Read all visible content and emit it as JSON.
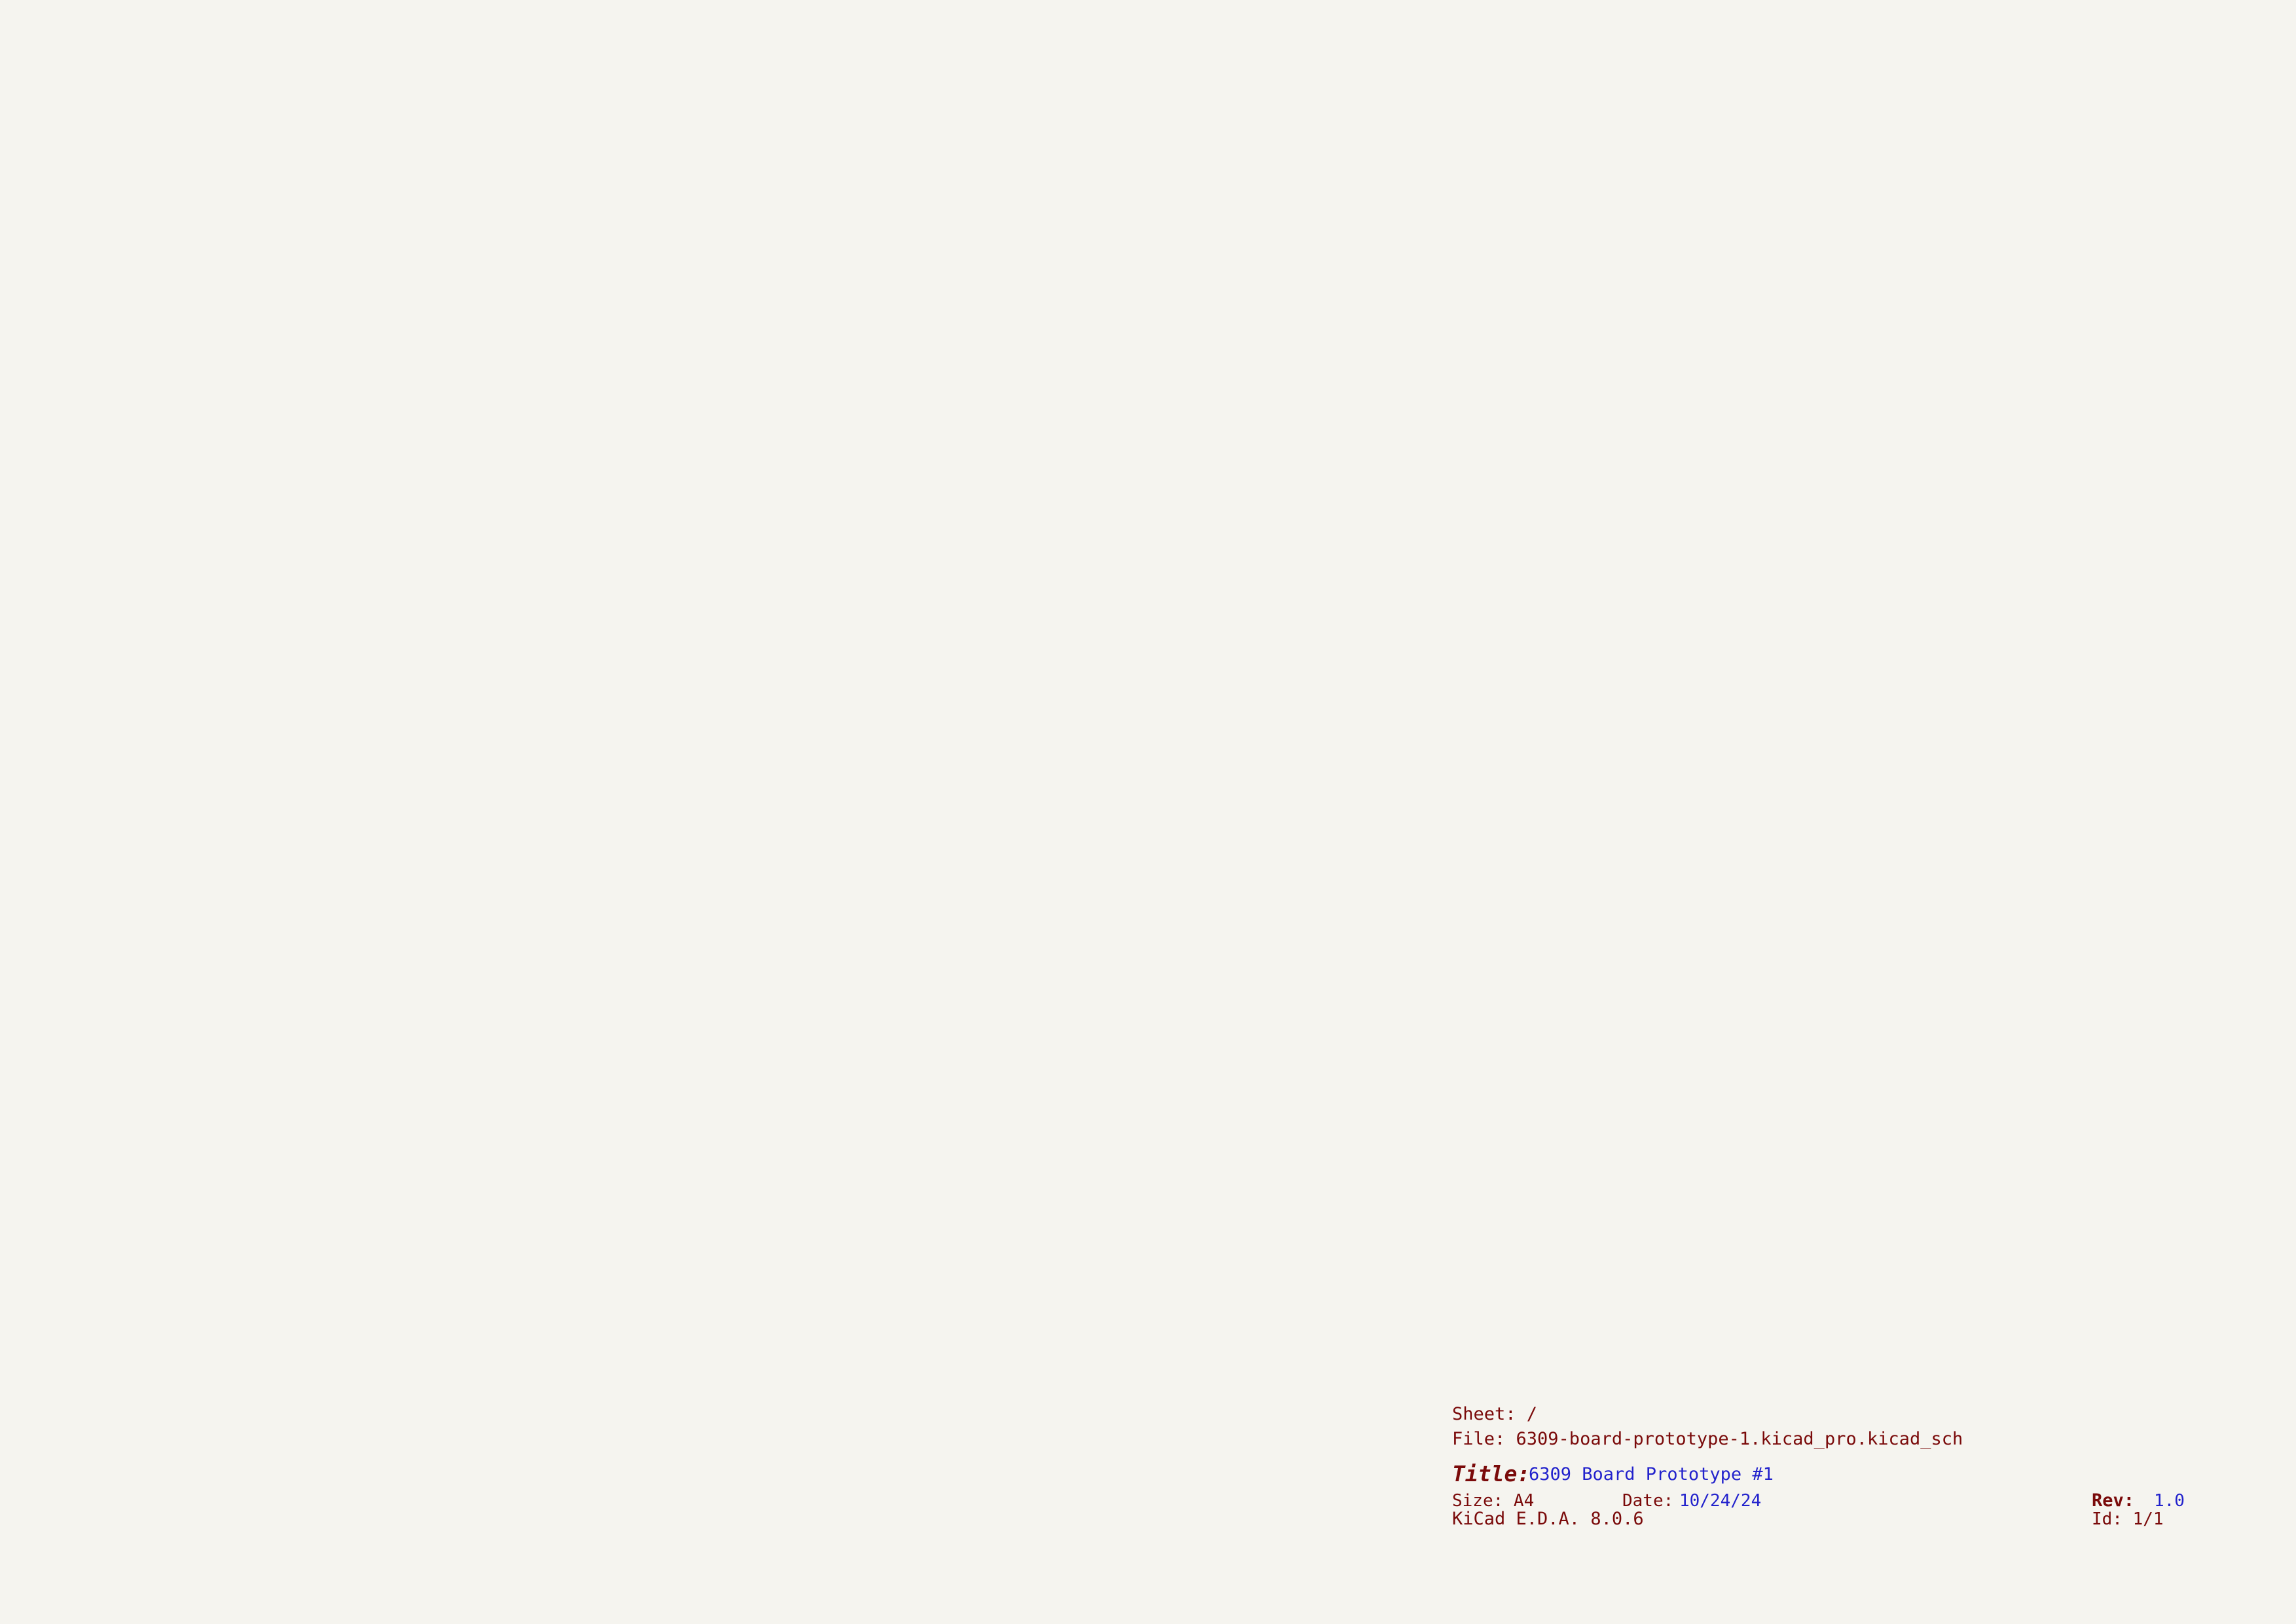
{
  "colors": {
    "background": "#F5F4EF",
    "wire": "#1DA41D",
    "bus": "#1616AE",
    "outline": "#7E0B0B",
    "body_fill": "#FDFAC4",
    "pin_number": "#9E1010",
    "pin_name": "#0E7C7C",
    "label": "#1F1F1F",
    "blue_text": "#2222CC",
    "frame": "#7A0A0A",
    "noconnect": "#2B2BC4"
  },
  "frame": {
    "columns": [
      "1",
      "2",
      "3",
      "4",
      "5",
      "6"
    ],
    "rows": [
      "A",
      "B",
      "C",
      "D"
    ]
  },
  "title_block": {
    "sheet": "Sheet: /",
    "file": "File: 6309-board-prototype-1.kicad_pro.kicad_sch",
    "title_label": "Title:",
    "title": "6309 Board Prototype #1",
    "size": "Size: A4",
    "date_label": "Date:",
    "date": "10/24/24",
    "rev_label": "Rev:",
    "rev": "1.0",
    "tool": "KiCad E.D.A. 8.0.6",
    "id": "Id: 1/1"
  },
  "sections": {
    "cpu": "CPU",
    "ram": "RAM",
    "rom": "ROM",
    "uart": "UART",
    "glue": "GLUE LOGIC",
    "power": "POWER + RESET SWITCH"
  },
  "power": {
    "vcc": "+5V"
  },
  "net_labels": {
    "rw": "R/!W",
    "reset": "!RESET",
    "a15": "A15",
    "na15": "!A15",
    "a8": "A8"
  },
  "ics": {
    "cpu": {
      "ref": "U1",
      "value": "HD63C09",
      "vcc_pin": "7",
      "vcc_name": "VCC",
      "gnd_pin": "1",
      "gnd_name": "VSS",
      "left": [
        {
          "label": "D0",
          "num": "31",
          "name": "D0"
        },
        {
          "label": "D1",
          "num": "30",
          "name": "D1"
        },
        {
          "label": "D2",
          "num": "29",
          "name": "D2"
        },
        {
          "label": "D3",
          "num": "28",
          "name": "D3"
        },
        {
          "label": "D4",
          "num": "27",
          "name": "D4"
        },
        {
          "label": "D5",
          "num": "26",
          "name": "D5"
        },
        {
          "label": "D6",
          "num": "25",
          "name": "D6"
        },
        {
          "label": "D7",
          "num": "24",
          "name": "D7"
        },
        {
          "label": "!RESET",
          "num": "37",
          "name": "RESET",
          "ov": true
        },
        {
          "num": "2",
          "name": "NMI",
          "ov": true
        },
        {
          "num": "3",
          "name": "IRQ",
          "ov": true
        },
        {
          "num": "4",
          "name": "FIRQ",
          "ov": true
        },
        {
          "num": "33",
          "name": "DMA/BREQ",
          "ov": true
        },
        {
          "num": "40",
          "name": "HALT",
          "ov": true
        },
        {
          "num": "36",
          "name": "MRDY"
        },
        {
          "num": "39",
          "name": "XTAL"
        },
        {
          "num": "38",
          "name": "EXTAL"
        }
      ],
      "right": [
        {
          "num": "8",
          "name": "A0",
          "label": "A0"
        },
        {
          "num": "9",
          "name": "A1",
          "label": "A1"
        },
        {
          "num": "10",
          "name": "A2",
          "label": "A2"
        },
        {
          "num": "11",
          "name": "A3",
          "label": "A3"
        },
        {
          "num": "12",
          "name": "A4",
          "label": "A4"
        },
        {
          "num": "13",
          "name": "A5",
          "label": "A5"
        },
        {
          "num": "14",
          "name": "A6",
          "label": "A6"
        },
        {
          "num": "15",
          "name": "A7",
          "label": "A7"
        },
        {
          "num": "16",
          "name": "A8",
          "label": "A8"
        },
        {
          "num": "17",
          "name": "A9",
          "label": "A9"
        },
        {
          "num": "18",
          "name": "A10",
          "label": "A10"
        },
        {
          "num": "19",
          "name": "A11",
          "label": "A11"
        },
        {
          "num": "20",
          "name": "A12",
          "label": "A12"
        },
        {
          "num": "21",
          "name": "A13",
          "label": "A13"
        },
        {
          "num": "22",
          "name": "A14",
          "label": "A14"
        },
        {
          "num": "23",
          "name": "A15",
          "label": "A15"
        },
        {
          "num": "32",
          "name": "R/W",
          "ov": "last",
          "label": "R/!W"
        },
        {
          "num": "5",
          "name": "BS",
          "nc": true
        },
        {
          "num": "6",
          "name": "BA",
          "nc": true
        },
        {
          "num": "34",
          "name": "E"
        },
        {
          "num": "35",
          "name": "Q",
          "nc": true
        }
      ]
    },
    "ram": {
      "ref": "U2",
      "value": "62256",
      "vcc_pin": "28",
      "vcc_name": "VCC",
      "gnd_pin": "14",
      "gnd_name": "GND",
      "left": [
        {
          "label": "A0",
          "num": "10",
          "name": "A0"
        },
        {
          "label": "A1",
          "num": "9",
          "name": "A1"
        },
        {
          "label": "A2",
          "num": "8",
          "name": "A2"
        },
        {
          "label": "A3",
          "num": "7",
          "name": "A3"
        },
        {
          "label": "A4",
          "num": "6",
          "name": "A4"
        },
        {
          "label": "A5",
          "num": "5",
          "name": "A5"
        },
        {
          "label": "A6",
          "num": "4",
          "name": "A6"
        },
        {
          "label": "A7",
          "num": "3",
          "name": "A7"
        },
        {
          "label": "A8",
          "num": "25",
          "name": "A8"
        },
        {
          "label": "A9",
          "num": "24",
          "name": "A9"
        },
        {
          "label": "A10",
          "num": "21",
          "name": "A10"
        },
        {
          "label": "A11",
          "num": "23",
          "name": "A11"
        },
        {
          "label": "A12",
          "num": "2",
          "name": "A12"
        },
        {
          "label": "A13",
          "num": "26",
          "name": "A13"
        },
        {
          "label": "A14",
          "num": "1",
          "name": "A14"
        }
      ],
      "right": [
        {
          "num": "11",
          "name": "Q0",
          "label": "D0"
        },
        {
          "num": "12",
          "name": "Q1",
          "label": "D1"
        },
        {
          "num": "13",
          "name": "Q2",
          "label": "D2"
        },
        {
          "num": "15",
          "name": "Q3",
          "label": "D3"
        },
        {
          "num": "16",
          "name": "Q4",
          "label": "D4"
        },
        {
          "num": "17",
          "name": "Q5",
          "label": "D5"
        },
        {
          "num": "18",
          "name": "Q6",
          "label": "D6"
        },
        {
          "num": "19",
          "name": "Q7",
          "label": "D7"
        },
        {
          "num": "20",
          "name": "CS",
          "ov": true
        },
        {
          "num": "22",
          "name": "OE",
          "ov": true
        },
        {
          "num": "27",
          "name": "WE",
          "ov": true,
          "label": "R/!W"
        }
      ]
    },
    "rom": {
      "ref": "U3",
      "value": "28C256",
      "vcc_pin": "28",
      "vcc_name": "VCC",
      "gnd_pin": "14",
      "gnd_name": "GND",
      "left": [
        {
          "label": "A0",
          "num": "10",
          "name": "A0"
        },
        {
          "label": "A1",
          "num": "9",
          "name": "A1"
        },
        {
          "label": "A2",
          "num": "8",
          "name": "A2"
        },
        {
          "label": "A3",
          "num": "7",
          "name": "A3"
        },
        {
          "label": "A4",
          "num": "6",
          "name": "A4"
        },
        {
          "label": "A5",
          "num": "5",
          "name": "A5"
        },
        {
          "label": "A6",
          "num": "4",
          "name": "A6"
        },
        {
          "label": "A7",
          "num": "3",
          "name": "A7"
        },
        {
          "label": "A8",
          "num": "25",
          "name": "A8"
        },
        {
          "label": "A9",
          "num": "24",
          "name": "A9"
        },
        {
          "label": "A10",
          "num": "21",
          "name": "A10"
        },
        {
          "label": "A11",
          "num": "23",
          "name": "A11"
        },
        {
          "label": "A12",
          "num": "2",
          "name": "A12"
        },
        {
          "label": "A13",
          "num": "26",
          "name": "A13"
        },
        {
          "label": "A14",
          "num": "1",
          "name": "A14"
        },
        {
          "num": "27",
          "name": "WE",
          "ov": true,
          "label": "R/!W"
        },
        {
          "num": "22",
          "name": "OE",
          "ov": true
        },
        {
          "num": "20",
          "name": "CS",
          "ov": true
        }
      ],
      "right": [
        {
          "num": "11",
          "name": "D0",
          "label": "D0"
        },
        {
          "num": "12",
          "name": "D1",
          "label": "D1"
        },
        {
          "num": "13",
          "name": "D2",
          "label": "D2"
        },
        {
          "num": "15",
          "name": "D3",
          "label": "D3"
        },
        {
          "num": "16",
          "name": "D4",
          "label": "D4"
        },
        {
          "num": "17",
          "name": "D5",
          "label": "D5"
        },
        {
          "num": "18",
          "name": "D6",
          "label": "D6"
        },
        {
          "num": "19",
          "name": "D7",
          "label": "D7"
        }
      ]
    },
    "uart": {
      "ref": "U4",
      "value": "16C550",
      "vcc_pin": "40",
      "vcc_name": "VCC",
      "gnd_pin": "20",
      "gnd_name": "GND",
      "left": [
        {
          "label": "D0",
          "num": "1",
          "name": "D0"
        },
        {
          "label": "D1",
          "num": "2",
          "name": "D1"
        },
        {
          "label": "D2",
          "num": "3",
          "name": "D2"
        },
        {
          "label": "D3",
          "num": "4",
          "name": "D3"
        },
        {
          "label": "D4",
          "num": "5",
          "name": "D4"
        },
        {
          "label": "D5",
          "num": "6",
          "name": "D5"
        },
        {
          "label": "D6",
          "num": "7",
          "name": "D6"
        },
        {
          "label": "D7",
          "num": "8",
          "name": "D7"
        },
        {
          "label": "A0",
          "num": "28",
          "name": "A0"
        },
        {
          "label": "A1",
          "num": "27",
          "name": "A1"
        },
        {
          "label": "A2",
          "num": "26",
          "name": "A2"
        },
        {
          "num": "12",
          "name": "CS0"
        },
        {
          "num": "13",
          "name": "CS1"
        },
        {
          "num": "14",
          "name": "CS2",
          "ov": true
        },
        {
          "num": "16",
          "name": "XIN"
        },
        {
          "num": "17",
          "name": "XOUT",
          "nc": true
        },
        {
          "num": "18",
          "name": "WR",
          "ov": true,
          "label": "R/!W"
        },
        {
          "num": "19",
          "name": "WR"
        },
        {
          "num": "22",
          "name": "RD",
          "label": "R/!W"
        },
        {
          "num": "21",
          "name": "RD",
          "ov": true
        },
        {
          "num": "25",
          "name": "ADS",
          "ov": true
        },
        {
          "num": "30",
          "name": "INTR"
        },
        {
          "num": "35",
          "name": "MR"
        }
      ],
      "right": [
        {
          "num": "39",
          "name": "RI",
          "ov": true,
          "nc": true
        },
        {
          "num": "38",
          "name": "DCD",
          "ov": true
        },
        {
          "num": "37",
          "name": "DSR",
          "ov": true
        },
        {
          "num": "36",
          "name": "CTS",
          "ov": true
        },
        {
          "num": "34",
          "name": "OUT1",
          "ov": true,
          "nc": true
        },
        {
          "num": "33",
          "name": "DTR",
          "ov": true,
          "nc": true
        },
        {
          "num": "32",
          "name": "RTS",
          "ov": true
        },
        {
          "num": "31",
          "name": "OUT2",
          "ov": true,
          "nc": true
        },
        {
          "num": "10",
          "name": "SIN"
        },
        {
          "num": "11",
          "name": "SOUT"
        },
        {
          "num": "29",
          "name": "RXRDY",
          "ov": true,
          "nc": true
        },
        {
          "num": "24",
          "name": "TXRDY",
          "ov": true,
          "nc": true
        },
        {
          "num": "23",
          "name": "DDIS",
          "nc": true
        },
        {
          "num": "15",
          "name": "BAUDOUT",
          "ov": true
        },
        {
          "num": "9",
          "name": "RCLK"
        }
      ]
    },
    "u7": {
      "ref": "U7",
      "value": "74HCT30",
      "amp": "&",
      "out_name": "K",
      "out_num": "8",
      "vcc_pin": "14",
      "vcc_name": "Vdd",
      "gnd_pin": "7",
      "gnd_name": "Vss",
      "inputs": [
        {
          "label": "A8",
          "num": "1",
          "name": "A"
        },
        {
          "label": "A9",
          "num": "2",
          "name": "B"
        },
        {
          "label": "A10",
          "num": "3",
          "name": "C"
        },
        {
          "label": "A11",
          "num": "4",
          "name": "D"
        },
        {
          "label": "A12",
          "num": "5",
          "name": "E"
        },
        {
          "label": "A13",
          "num": "6",
          "name": "F"
        },
        {
          "label": "A14",
          "num": "11",
          "name": "G"
        },
        {
          "label": "!A15",
          "num": "12",
          "name": "H"
        }
      ]
    },
    "u5a": {
      "ref": "U5A",
      "value": "74HCT04",
      "in": "1",
      "out": "2"
    },
    "u5b": {
      "ref": "U5B",
      "value": "74HCT04",
      "in": "3",
      "out": "4"
    },
    "u5c": {
      "ref": "U5C",
      "value": "74HCT04",
      "in": "5",
      "out": "6"
    },
    "u6a": {
      "ref": "U6A",
      "value": "74HCT32",
      "out": "3",
      "in1": "1",
      "in2": "2",
      "in1_label": "A15",
      "in2_label": "A8"
    },
    "u5g": {
      "ref": "U5G",
      "value": "74HCT04",
      "vcc_pin": "14",
      "gnd_pin": "7",
      "vcc_name": "VCC",
      "gnd_name": "GND"
    },
    "u6e": {
      "ref": "U6E",
      "value": "74HCT32",
      "vcc_pin": "14",
      "gnd_pin": "7",
      "vcc_name": "VCC",
      "gnd_name": "GND"
    }
  },
  "passives": {
    "c1": {
      "ref": "C1",
      "value": "0.01uF"
    },
    "c2": {
      "ref": "C2",
      "value": "0.01uF"
    },
    "c3": {
      "ref": "C3",
      "value": "0.01uF"
    },
    "c4": {
      "ref": "C4",
      "value": "0.01uF"
    },
    "c5": {
      "ref": "C5",
      "value": "0.01uF"
    },
    "c6": {
      "ref": "C6",
      "value": "0.01uF"
    },
    "c7": {
      "ref": "C7",
      "value": "0.01uf"
    },
    "c8": {
      "ref": "C8",
      "value": "20pF"
    },
    "c9": {
      "ref": "C9",
      "value": "20pF"
    },
    "c10": {
      "ref": "C10",
      "value": "100nF"
    },
    "r1": {
      "ref": "R1",
      "value": "1K"
    },
    "x1": {
      "ref": "X1",
      "value": "12MHz"
    },
    "x2": {
      "ref": "X2",
      "value": "1.8432MHz",
      "pin_vcc": "8",
      "pin_out": "5",
      "pin_en": "1",
      "pin_gnd": "4",
      "name_vcc": "Vcc",
      "name_out": "OUT",
      "name_en": "EN",
      "name_gnd": "GND"
    },
    "sw1": {
      "ref": "SW1",
      "value": "SW_Push"
    }
  },
  "connectors": {
    "j1": {
      "ref": "J1",
      "value": "PWR",
      "net": "+5V",
      "pins": [
        "1",
        "2"
      ]
    },
    "j2": {
      "ref": "J2",
      "value": "FTDI",
      "pins": [
        {
          "label": "GND",
          "num": "1"
        },
        {
          "label": "CTS",
          "num": "2"
        },
        {
          "label": "5V",
          "num": "3"
        },
        {
          "label": "TX",
          "num": "4"
        },
        {
          "label": "RX",
          "num": "5"
        },
        {
          "label": "RTS",
          "num": "6"
        }
      ]
    }
  }
}
